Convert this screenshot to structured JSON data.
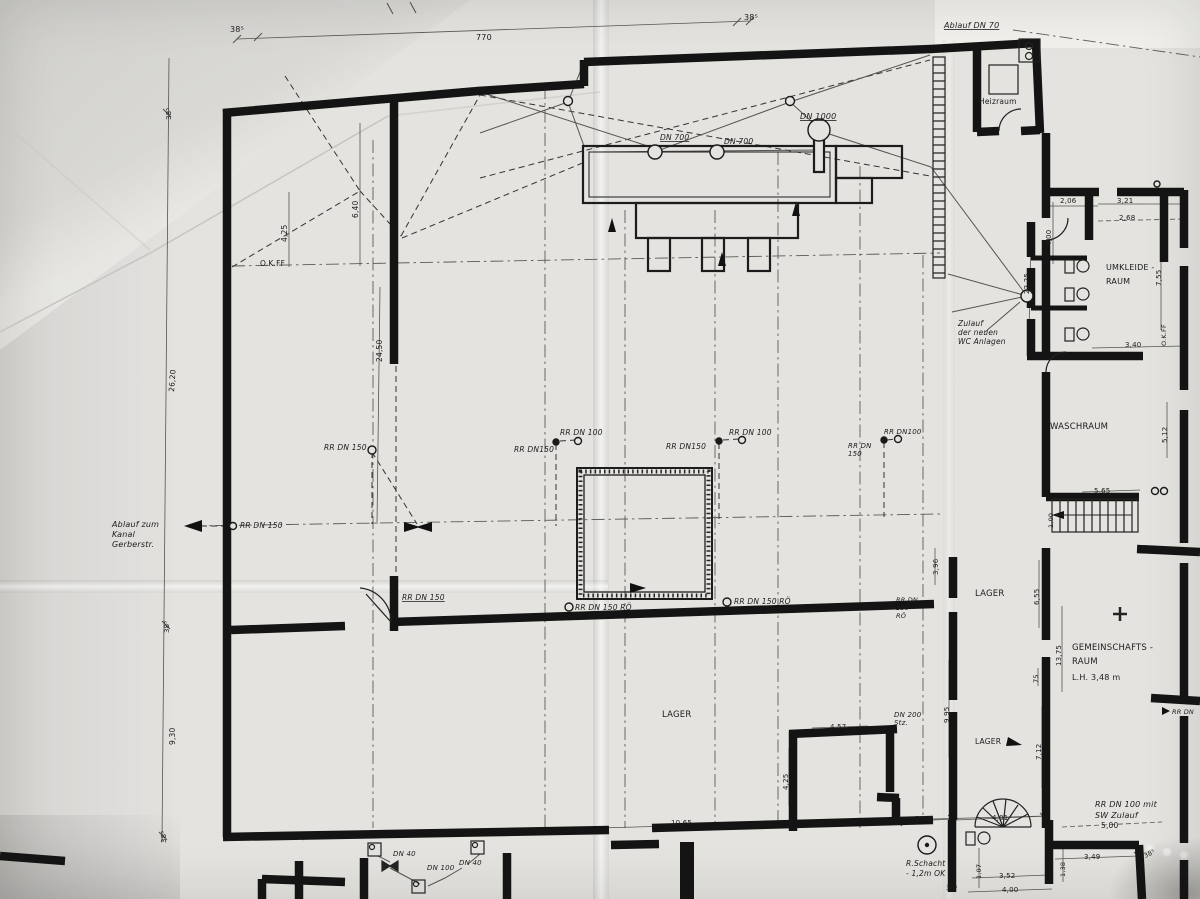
{
  "plan": {
    "paper_color": "#e4e3df",
    "ink_color": "#161616",
    "labels": [
      {
        "t": "38⁵",
        "x": 230,
        "y": 32,
        "s": 8
      },
      {
        "t": "770",
        "x": 476,
        "y": 40,
        "s": 8
      },
      {
        "t": "38⁵",
        "x": 744,
        "y": 20,
        "s": 8
      },
      {
        "t": "Ablauf  DN 70",
        "x": 944,
        "y": 28,
        "s": 8,
        "u": 1,
        "i": 1
      },
      {
        "t": "Heizraum",
        "x": 979,
        "y": 104,
        "s": 7.5
      },
      {
        "t": "DN 1000",
        "x": 800,
        "y": 119,
        "s": 8,
        "u": 1,
        "i": 1
      },
      {
        "t": "DN 700",
        "x": 660,
        "y": 140,
        "s": 7.5,
        "u": 1,
        "i": 1
      },
      {
        "t": "DN 700",
        "x": 724,
        "y": 144,
        "s": 7.5,
        "u": 1,
        "i": 1
      },
      {
        "t": "38⁵",
        "x": 171,
        "y": 120,
        "s": 7,
        "r": -90
      },
      {
        "t": "4,25",
        "x": 287,
        "y": 242,
        "s": 7.5,
        "r": -90
      },
      {
        "t": "6,40",
        "x": 358,
        "y": 218,
        "s": 7.5,
        "r": -90
      },
      {
        "t": "O.K.FF",
        "x": 260,
        "y": 266,
        "s": 7.5
      },
      {
        "t": "24,50",
        "x": 382,
        "y": 362,
        "s": 7.5,
        "r": -90
      },
      {
        "t": "26,20",
        "x": 174,
        "y": 392,
        "s": 7.5,
        "r": -86
      },
      {
        "t": "RR DN 150",
        "x": 324,
        "y": 450,
        "s": 7.5,
        "i": 1
      },
      {
        "t": "RR DN150",
        "x": 514,
        "y": 452,
        "s": 7.5,
        "i": 1
      },
      {
        "t": "RR DN 100",
        "x": 560,
        "y": 435,
        "s": 7.5,
        "i": 1
      },
      {
        "t": "RR DN150",
        "x": 666,
        "y": 449,
        "s": 7.5,
        "i": 1
      },
      {
        "t": "RR DN 100",
        "x": 729,
        "y": 435,
        "s": 7.5,
        "i": 1
      },
      {
        "t": "RR DN\n150",
        "x": 848,
        "y": 448,
        "s": 7,
        "lh": 8,
        "i": 1
      },
      {
        "t": "RR DN100",
        "x": 884,
        "y": 434,
        "s": 7,
        "i": 1
      },
      {
        "t": "Ablauf zum\nKanal\nGerberstr.",
        "x": 112,
        "y": 527,
        "s": 8,
        "lh": 10,
        "i": 1
      },
      {
        "t": "RR DN 150",
        "x": 240,
        "y": 528,
        "s": 7.5,
        "i": 1
      },
      {
        "t": "RR DN 150",
        "x": 402,
        "y": 600,
        "s": 7.5,
        "u": 1,
        "i": 1
      },
      {
        "t": "RR DN 150 RÖ",
        "x": 575,
        "y": 610,
        "s": 7.5,
        "i": 1
      },
      {
        "t": "RR DN 150 RÖ",
        "x": 734,
        "y": 604,
        "s": 7.5,
        "i": 1
      },
      {
        "t": "Zulauf\nder neuen\nWC Anlagen",
        "x": 958,
        "y": 326,
        "s": 7.5,
        "lh": 9,
        "i": 1
      },
      {
        "t": "22,25",
        "x": 1029,
        "y": 294,
        "s": 7,
        "r": -90
      },
      {
        "t": "UMKLEIDE -\nRAUM",
        "x": 1106,
        "y": 270,
        "s": 8,
        "lh": 14
      },
      {
        "t": "2,06",
        "x": 1060,
        "y": 203,
        "s": 7
      },
      {
        "t": "3,21",
        "x": 1117,
        "y": 203,
        "s": 7
      },
      {
        "t": "2,68",
        "x": 1119,
        "y": 220,
        "s": 7
      },
      {
        "t": "4,00",
        "x": 1051,
        "y": 246,
        "s": 7,
        "r": -90
      },
      {
        "t": "7,55",
        "x": 1161,
        "y": 286,
        "s": 7,
        "r": -90
      },
      {
        "t": "O.K.FF",
        "x": 1166,
        "y": 346,
        "s": 6.5,
        "r": -90
      },
      {
        "t": "3,40",
        "x": 1125,
        "y": 347,
        "s": 7
      },
      {
        "t": "WASCHRAUM",
        "x": 1050,
        "y": 429,
        "s": 8.5
      },
      {
        "t": "5,12",
        "x": 1167,
        "y": 443,
        "s": 7,
        "r": -90
      },
      {
        "t": "5,65",
        "x": 1094,
        "y": 493,
        "s": 7
      },
      {
        "t": "1,00",
        "x": 1053,
        "y": 528,
        "s": 6.5,
        "r": -90
      },
      {
        "t": "3,96",
        "x": 938,
        "y": 575,
        "s": 7,
        "r": -90
      },
      {
        "t": "RR DN\n150\nRÖ",
        "x": 896,
        "y": 602,
        "s": 6.5,
        "lh": 8,
        "i": 1
      },
      {
        "t": "LAGER",
        "x": 975,
        "y": 596,
        "s": 8.5
      },
      {
        "t": "6,55",
        "x": 1039,
        "y": 605,
        "s": 7,
        "r": -90
      },
      {
        "t": "13,75",
        "x": 1061,
        "y": 666,
        "s": 7,
        "r": -90
      },
      {
        "t": "GEMEINSCHAFTS -\nRAUM",
        "x": 1072,
        "y": 650,
        "s": 8.5,
        "lh": 14
      },
      {
        "t": "L.H.  3,48 m",
        "x": 1072,
        "y": 680,
        "s": 8
      },
      {
        "t": "75",
        "x": 1038,
        "y": 683,
        "s": 6.5,
        "r": -90
      },
      {
        "t": "LAGER",
        "x": 662,
        "y": 717,
        "s": 8.5
      },
      {
        "t": "4,57",
        "x": 830,
        "y": 729,
        "s": 7
      },
      {
        "t": "DN 200\nStz.",
        "x": 894,
        "y": 717,
        "s": 7,
        "lh": 8,
        "i": 1
      },
      {
        "t": "9,95",
        "x": 949,
        "y": 723,
        "s": 7,
        "r": -90
      },
      {
        "t": "LAGER",
        "x": 975,
        "y": 744,
        "s": 7.5
      },
      {
        "t": "7,12",
        "x": 1041,
        "y": 760,
        "s": 7,
        "r": -90
      },
      {
        "t": "4,25",
        "x": 788,
        "y": 790,
        "s": 7,
        "r": -90
      },
      {
        "t": "10,65",
        "x": 671,
        "y": 825,
        "s": 7
      },
      {
        "t": "2,52",
        "x": 915,
        "y": 821,
        "s": 7
      },
      {
        "t": "4,01",
        "x": 992,
        "y": 820,
        "s": 7
      },
      {
        "t": "RR DN 100 mit\nSW Zulauf",
        "x": 1095,
        "y": 807,
        "s": 8,
        "lh": 11,
        "i": 1
      },
      {
        "t": "5,00",
        "x": 1101,
        "y": 828,
        "s": 7.5
      },
      {
        "t": "R.Schacht\n- 1,2m OK",
        "x": 906,
        "y": 866,
        "s": 7.5,
        "lh": 10,
        "i": 1
      },
      {
        "t": "1,07",
        "x": 981,
        "y": 879,
        "s": 6.5,
        "r": -90
      },
      {
        "t": "3,52",
        "x": 999,
        "y": 878,
        "s": 7
      },
      {
        "t": "1,38",
        "x": 1065,
        "y": 877,
        "s": 6.5,
        "r": -90
      },
      {
        "t": "3,49",
        "x": 1084,
        "y": 859,
        "s": 7
      },
      {
        "t": "38⁵",
        "x": 1145,
        "y": 858,
        "s": 6.5,
        "r": -25
      },
      {
        "t": "4,00",
        "x": 1002,
        "y": 892,
        "s": 7
      },
      {
        "t": "38⁵",
        "x": 946,
        "y": 890,
        "s": 6.5
      },
      {
        "t": "DN 40",
        "x": 393,
        "y": 856,
        "s": 7,
        "i": 1
      },
      {
        "t": "DN 100",
        "x": 427,
        "y": 870,
        "s": 7,
        "i": 1
      },
      {
        "t": "DN 40",
        "x": 459,
        "y": 865,
        "s": 7,
        "i": 1
      },
      {
        "t": "38⁵",
        "x": 169,
        "y": 633,
        "s": 7,
        "r": -90
      },
      {
        "t": "9,30",
        "x": 175,
        "y": 745,
        "s": 7.5,
        "r": -90
      },
      {
        "t": "38⁵",
        "x": 166,
        "y": 843,
        "s": 7,
        "r": -90
      },
      {
        "t": "HE",
        "x": 1189,
        "y": 556,
        "s": 8
      },
      {
        "t": "RR DN",
        "x": 1172,
        "y": 714,
        "s": 6.5,
        "i": 1
      }
    ]
  }
}
